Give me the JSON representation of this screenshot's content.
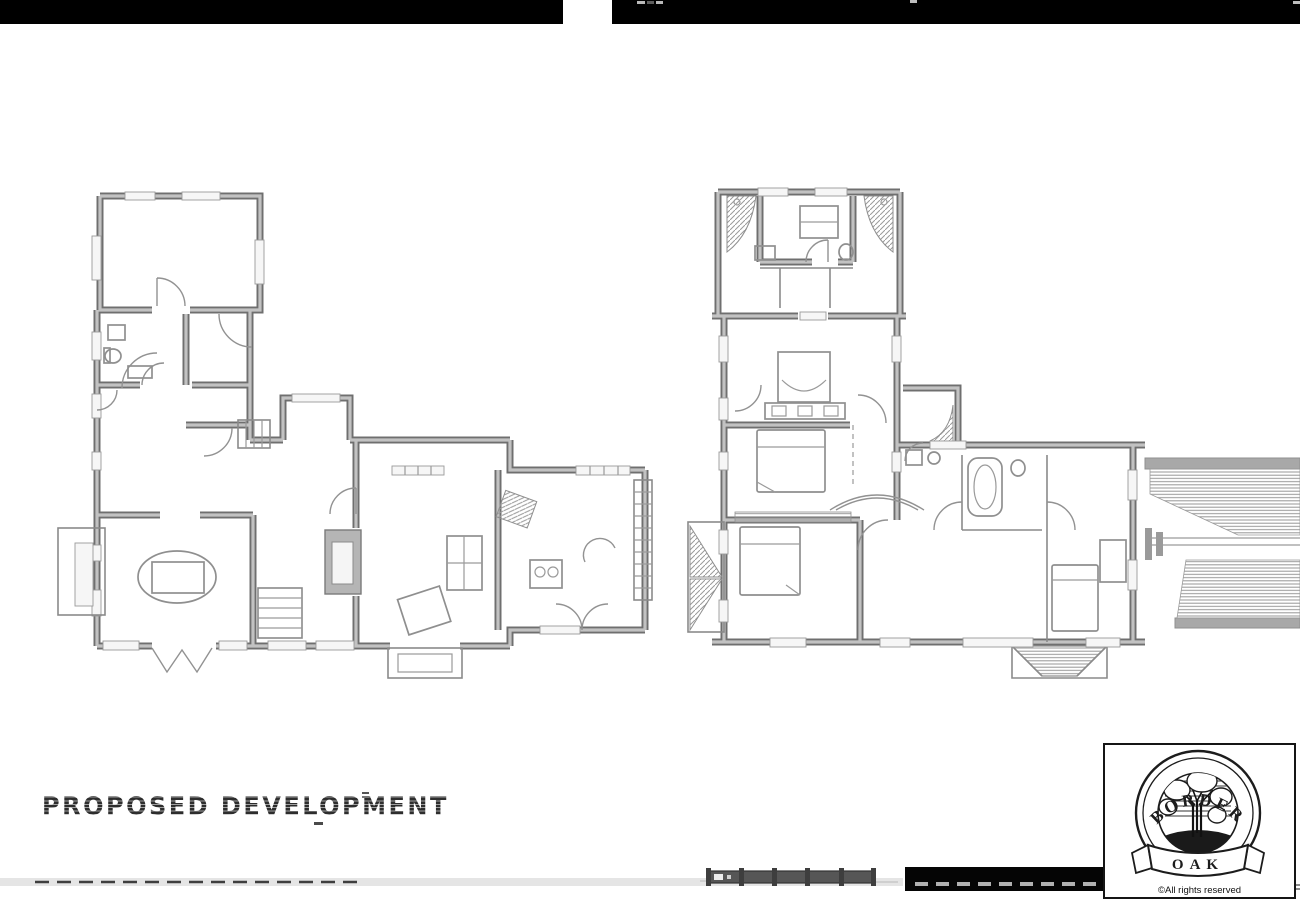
{
  "page": {
    "width": 1300,
    "height": 912,
    "background": "#ffffff"
  },
  "title": {
    "text": "PROPOSED DEVELOPMENT",
    "color": "#2d2d2d"
  },
  "logo": {
    "arc_text": "BORDER",
    "banner_text": "OAK",
    "caption": "©All rights reserved",
    "box_border": "#151515"
  },
  "colors": {
    "wall_outline": "#6f6f6f",
    "wall_core": "#c2c2c2",
    "line_work": "#8a8a8a",
    "hatch": "#9f9f9f",
    "scan_bar_black": "#000000",
    "light_band": "#e2e2e2",
    "scale_bar_dark": "#555555",
    "dash_marks": "#3f3f3f"
  },
  "plans": {
    "left": {
      "id": "ground-floor-plan"
    },
    "right": {
      "id": "first-floor-plan"
    }
  },
  "scale_bar": {
    "segments": 5
  }
}
